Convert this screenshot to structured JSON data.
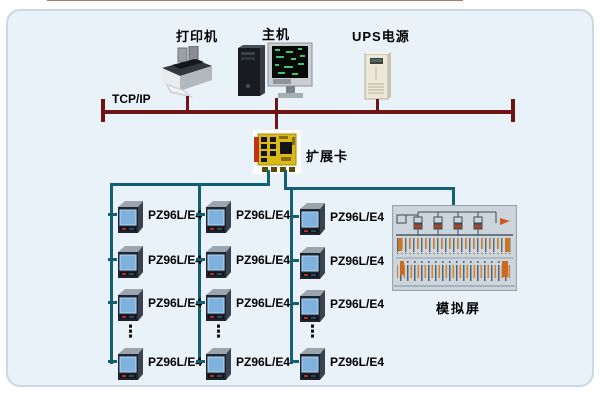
{
  "diagram": {
    "type": "power-monitoring-system-topology",
    "background_color": "#e9f1f9",
    "bus_color": "#6f1513",
    "line_color": "#135f74"
  },
  "network": {
    "bus_label": "TCP/IP"
  },
  "top_devices": {
    "printer": {
      "label": "打印机"
    },
    "host": {
      "label": "主机"
    },
    "ups": {
      "label": "UPS电源"
    }
  },
  "expansion_card": {
    "label": "扩展卡"
  },
  "meter_columns": [
    {
      "ellipsis": "⋮",
      "rows": [
        {
          "label": "PZ96L/E4"
        },
        {
          "label": "PZ96L/E4"
        },
        {
          "label": "PZ96L/E4"
        },
        {
          "label": "PZ96L/E4"
        }
      ]
    },
    {
      "ellipsis": "⋮",
      "rows": [
        {
          "label": "PZ96L/E4"
        },
        {
          "label": "PZ96L/E4"
        },
        {
          "label": "PZ96L/E4"
        },
        {
          "label": "PZ96L/E4"
        }
      ]
    },
    {
      "ellipsis": "⋮",
      "rows": [
        {
          "label": "PZ96L/E4"
        },
        {
          "label": "PZ96L/E4"
        },
        {
          "label": "PZ96L/E4"
        },
        {
          "label": "PZ96L/E4"
        }
      ]
    }
  ],
  "mimic_panel": {
    "label": "模拟屏"
  },
  "icons": {
    "printer": "printer-icon",
    "host": "host-computer-icon",
    "ups": "ups-tower-icon",
    "expansion_card": "expansion-card-icon",
    "meter": "power-meter-icon",
    "mimic_panel": "mimic-panel-image"
  }
}
